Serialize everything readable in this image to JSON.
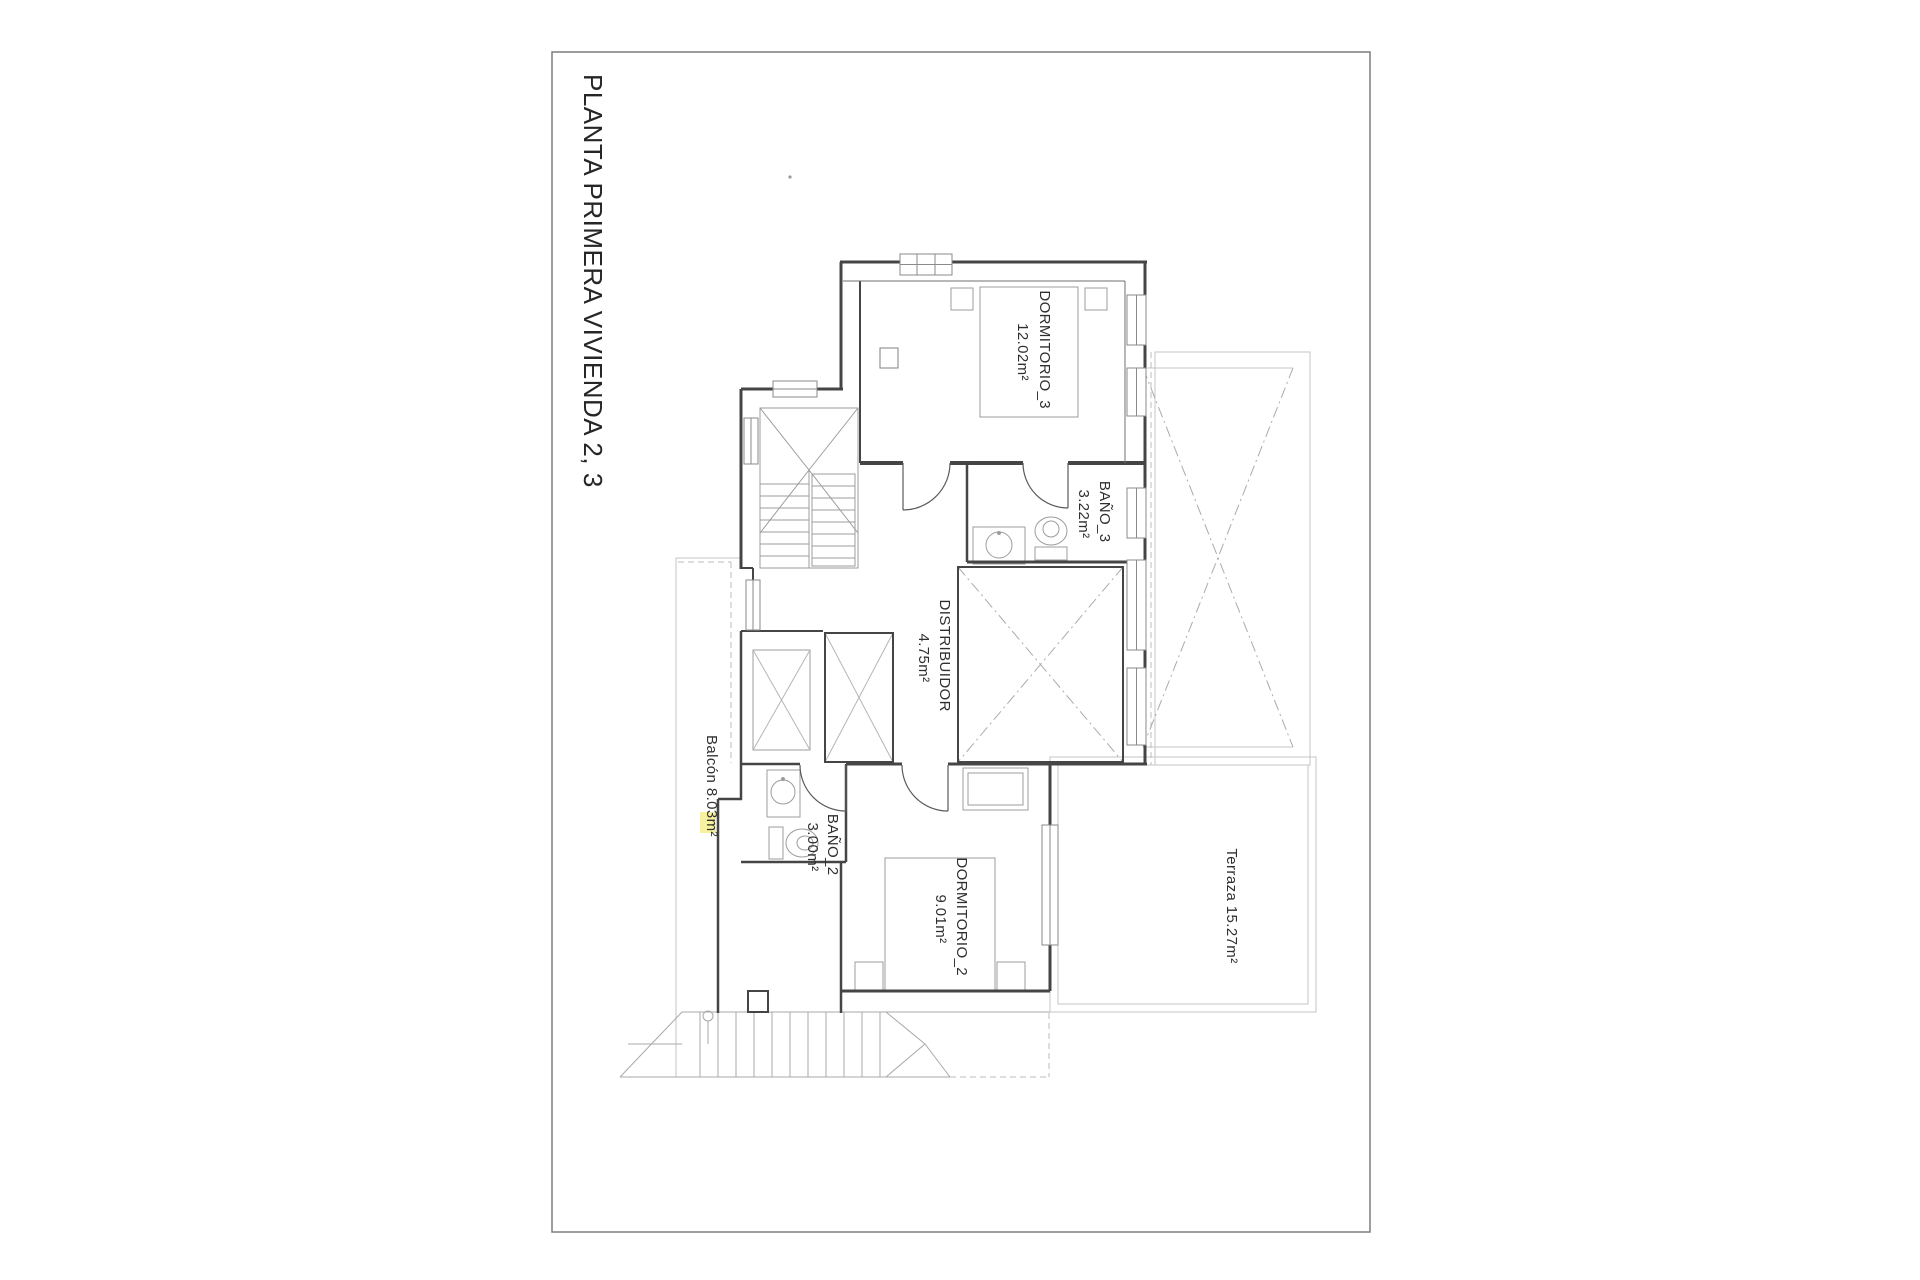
{
  "page": {
    "title": "PLANTA PRIMERA VIVIENDA 2, 3"
  },
  "colors": {
    "wall": "#454545",
    "furniture": "#9c9c9c",
    "faint": "#c4c4c4",
    "text": "#2f2f2f",
    "highlight": "#f6f0a0"
  },
  "rooms": {
    "dormitorio3": {
      "name": "DORMITORIO_3",
      "area": "12.02m²"
    },
    "bano3": {
      "name": "BAÑO_3",
      "area": "3.22m²"
    },
    "distribuidor": {
      "name": "DISTRIBUIDOR",
      "area": "4.75m²"
    },
    "bano2": {
      "name": "BAÑO_2",
      "area": "3.00m²"
    },
    "dormitorio2": {
      "name": "DORMITORIO_2",
      "area": "9.01m²"
    },
    "terraza": {
      "label": "Terraza 15.27m²"
    },
    "balcon": {
      "label": "Balcón 8.03m²"
    }
  }
}
